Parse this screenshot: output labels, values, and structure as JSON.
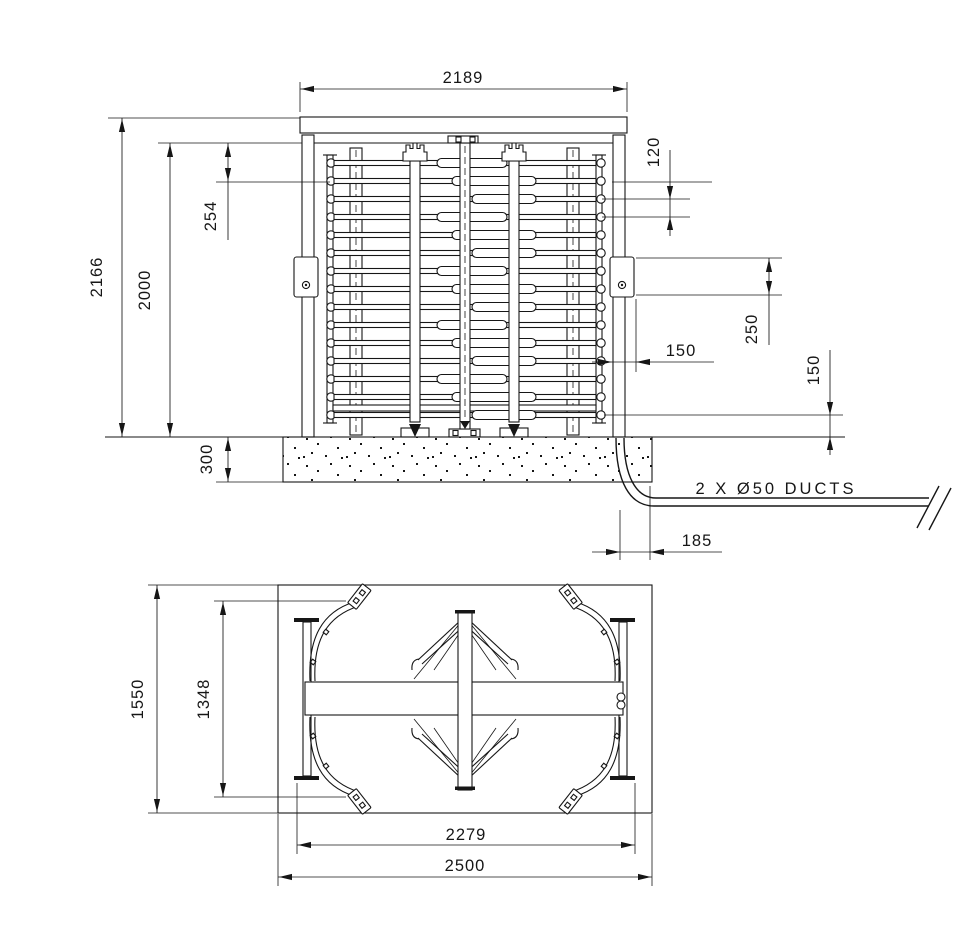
{
  "drawing": {
    "front_view": {
      "overall_width": "2189",
      "overall_height": "2166",
      "cage_height": "2000",
      "top_offset": "254",
      "foundation_depth": "300",
      "bar_pitch": "120",
      "reader_box_height": "250",
      "reader_offset": "150",
      "bottom_bar_height": "150",
      "duct_offset": "185",
      "duct_note": "2 X Ø50 DUCTS"
    },
    "plan_view": {
      "overall_depth": "1550",
      "inner_depth": "1348",
      "post_spacing": "2279",
      "overall_width": "2500"
    }
  }
}
